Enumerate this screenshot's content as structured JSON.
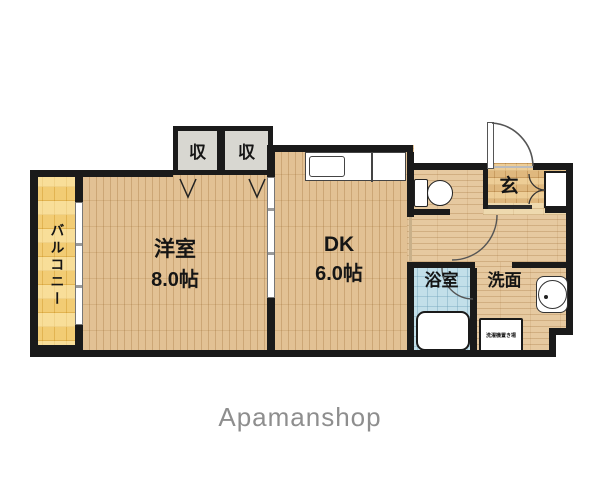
{
  "plan": {
    "balcony": {
      "label": "バルコニー"
    },
    "western_room": {
      "name": "洋室",
      "size": "8.0帖"
    },
    "dk": {
      "name": "DK",
      "size": "6.0帖"
    },
    "closets": [
      {
        "label": "収"
      },
      {
        "label": "収"
      }
    ],
    "entrance": {
      "label": "玄"
    },
    "bathroom": {
      "label": "浴室"
    },
    "washroom": {
      "label": "洗面"
    },
    "washer_box": {
      "label": "洗濯機置き場"
    }
  },
  "footer": {
    "brand": "Apamanshop"
  },
  "colors": {
    "wall": "#1a1a1a",
    "wood_floor": "#e2c194",
    "balcony_floor": "#f2cc74",
    "bathroom_floor": "#c2dfe9",
    "closet_fill": "#d8d7d1",
    "entrance_floor": "#dfb87e",
    "brand_text": "#8e8e8e"
  }
}
